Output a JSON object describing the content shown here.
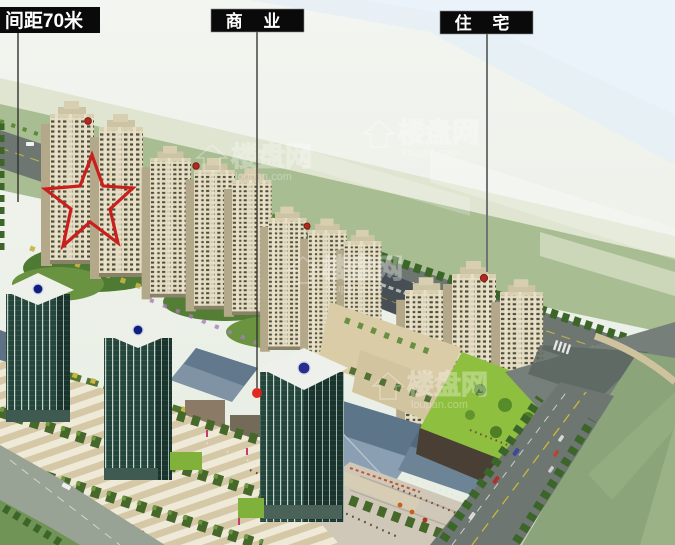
{
  "annotations": {
    "labels": [
      {
        "text": "间距70米"
      },
      {
        "text": "商 业"
      },
      {
        "text": "住 宅"
      }
    ],
    "markers": [
      {
        "name": "red-star-outline",
        "color": "#c9201d"
      },
      {
        "name": "red-dot",
        "color": "#e21d14"
      }
    ]
  },
  "watermark": {
    "brand": "楼盘网",
    "domain": "loupan.com"
  },
  "colors": {
    "label_bg": "#0a0a0a",
    "label_text": "#ffffff",
    "annotation_red": "#c9201d",
    "sky": "#eef2ec",
    "hill_green": "#a8bd92",
    "road_asphalt": "#6e7671",
    "residential_wall": "#e4dcc0",
    "glass_tower": "#24453c",
    "roof_blue": "#7f93a5",
    "plaza_paving": "#e9e2d0",
    "lawn_field": "#8ca47a",
    "tower_logo_blue": "#10207a"
  }
}
